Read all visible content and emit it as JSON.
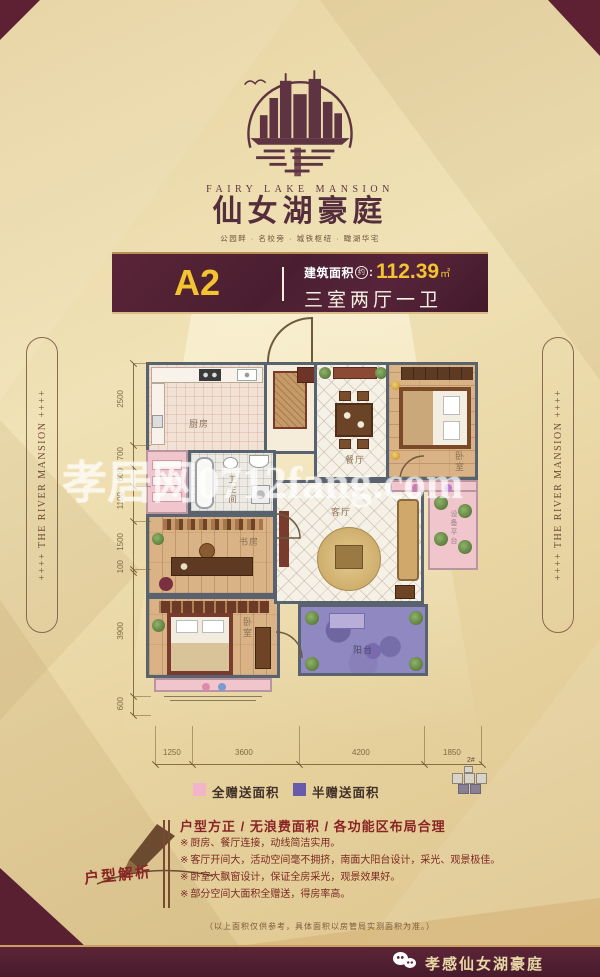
{
  "logo": {
    "en": "FAIRY LAKE MANSION",
    "cn": "仙女湖豪庭",
    "tagline": "公园畔 · 名校旁 · 城铁枢纽 · 瞰湖华宅"
  },
  "banner": {
    "unit": "A2",
    "area_label": "建筑面积",
    "area_circle": "约",
    "colon": ":",
    "area_value": "112.39",
    "area_unit": "㎡",
    "layout": "三室两厅一卫"
  },
  "side_banner": {
    "text": "++++  THE RIVER MANSION  ++++"
  },
  "floorplan": {
    "rooms": {
      "kitchen": "厨房",
      "bathroom": "卫生间",
      "dining": "餐厅",
      "bedroom_master": "卧室",
      "living": "客厅",
      "study": "书房",
      "bedroom_second": "卧室",
      "balcony": "阳台",
      "equipment": "设备平台"
    },
    "watermark": "孝居网0712fang.com",
    "dims_left": [
      "2500",
      "700",
      "600",
      "1100",
      "1500",
      "100",
      "3900",
      "600"
    ],
    "dims_bottom": [
      "1250",
      "3600",
      "4200",
      "1850"
    ]
  },
  "legend": {
    "full_gift": "全赠送面积",
    "half_gift": "半赠送面积",
    "full_gift_color": "#f2b4c8",
    "half_gift_color": "#695bab",
    "keyplan": "2#"
  },
  "analysis": {
    "stamp": "户型解析",
    "title": "户型方正 / 无浪费面积 / 各功能区布局合理",
    "marker": "※",
    "bullets": [
      "厨房、餐厅连接，动线简洁实用。",
      "客厅开间大，活动空间毫不拥挤，南面大阳台设计，采光、观景极佳。",
      "卧室大飘窗设计，保证全房采光，观景效果好。",
      "部分空间大面积全赠送，得房率高。"
    ]
  },
  "disclaimer": "（以上面积仅供参考，具体面积以房管局实测面积为准。）",
  "footer": {
    "brand": "孝感仙女湖豪庭"
  },
  "colors": {
    "maroon": "#5c2537",
    "gold": "#f3c430",
    "beige": "#e9d6a5"
  }
}
